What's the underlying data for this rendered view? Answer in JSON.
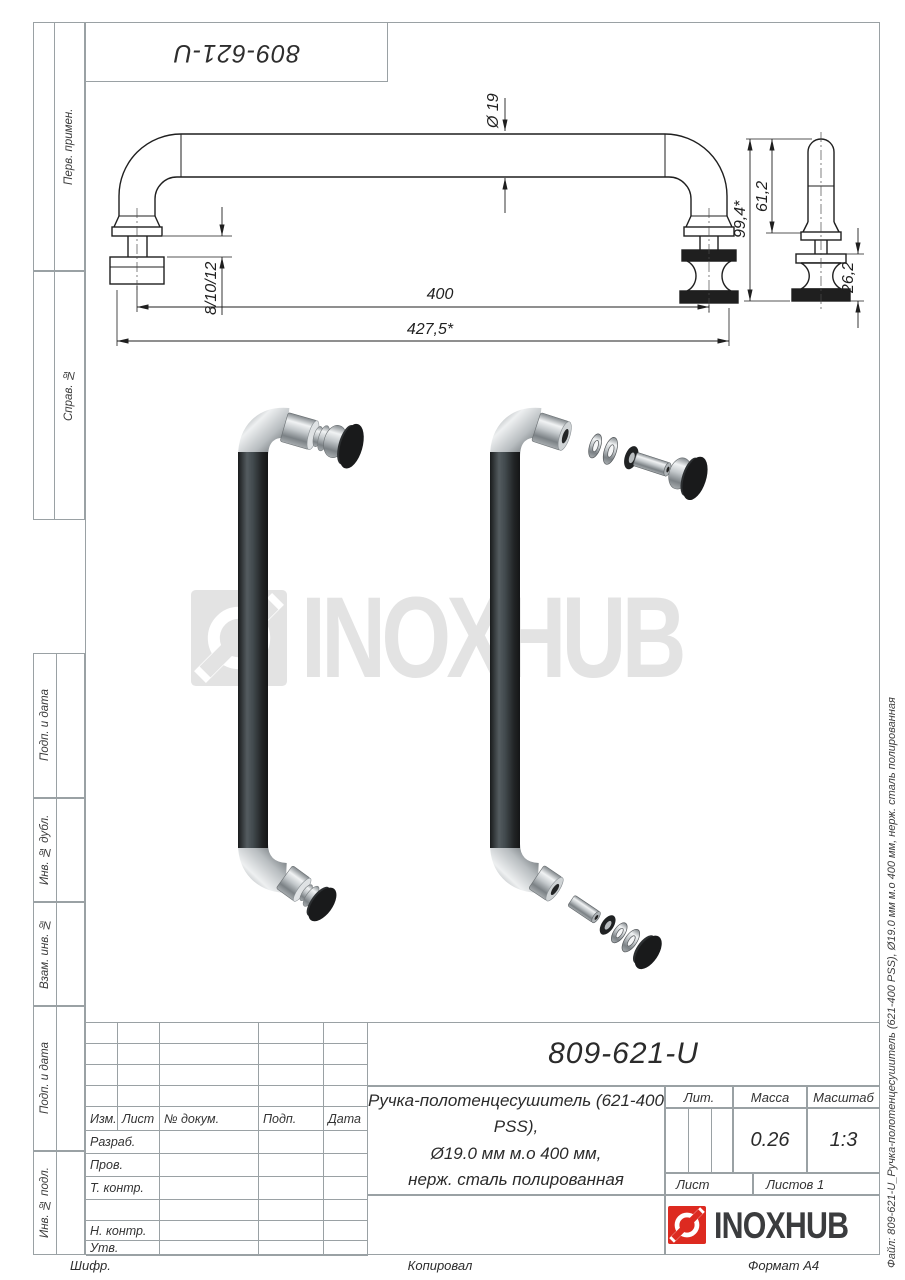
{
  "page": {
    "bg": "#ffffff",
    "frame_color": "#9aa1a4",
    "ink": "#1f1f1f",
    "accent_red": "#dd2a20"
  },
  "top_stamp": {
    "designation": "809-621-U"
  },
  "left_margin": {
    "sections": [
      {
        "label": "Перв. примен."
      },
      {
        "label": "Справ. №"
      },
      {
        "label": "Подп. и дата"
      },
      {
        "label": "Инв. № дубл."
      },
      {
        "label": "Взам. инв. №"
      },
      {
        "label": "Подп. и дата"
      },
      {
        "label": "Инв. № подл."
      }
    ]
  },
  "drawing": {
    "dims": {
      "diameter": "Ø 19",
      "glass_thickness": "8/10/12",
      "hole_spacing": "400",
      "overall_length": "427,5*",
      "side_upper": "61,2",
      "side_total": "99,4*",
      "side_lower": "26,2"
    }
  },
  "watermark": {
    "text": "INOXHUB"
  },
  "title_block": {
    "designation": "809-621-U",
    "name_line1": "Ручка-полотенцесушитель (621-400 PSS),",
    "name_line2": "Ø19.0 мм м.о 400 мм,",
    "name_line3": "нерж. сталь полированная",
    "col_izm": "Изм.",
    "col_list": "Лист",
    "col_doc": "№ докум.",
    "col_sign": "Подп.",
    "col_date": "Дата",
    "row_razrab": "Разраб.",
    "row_prov": "Пров.",
    "row_tkontr": "Т. контр.",
    "row_nkontr": "Н. контр.",
    "row_utv": "Утв.",
    "lit_label": "Лит.",
    "mass_label": "Масса",
    "scale_label": "Масштаб",
    "mass_value": "0.26",
    "scale_value": "1:3",
    "sheet_label": "Лист",
    "sheets_label": "Листов 1",
    "brand": "INOXHUB"
  },
  "footer": {
    "cipher": "Шифр.",
    "copied": "Копировал",
    "format": "Формат А4"
  },
  "right_margin": {
    "file_label": "Файл: 809-621-U_Ручка-полотенцесушитель (621-400 PSS), Ø19.0 мм м.о 400 мм, нерж. сталь полированная"
  }
}
